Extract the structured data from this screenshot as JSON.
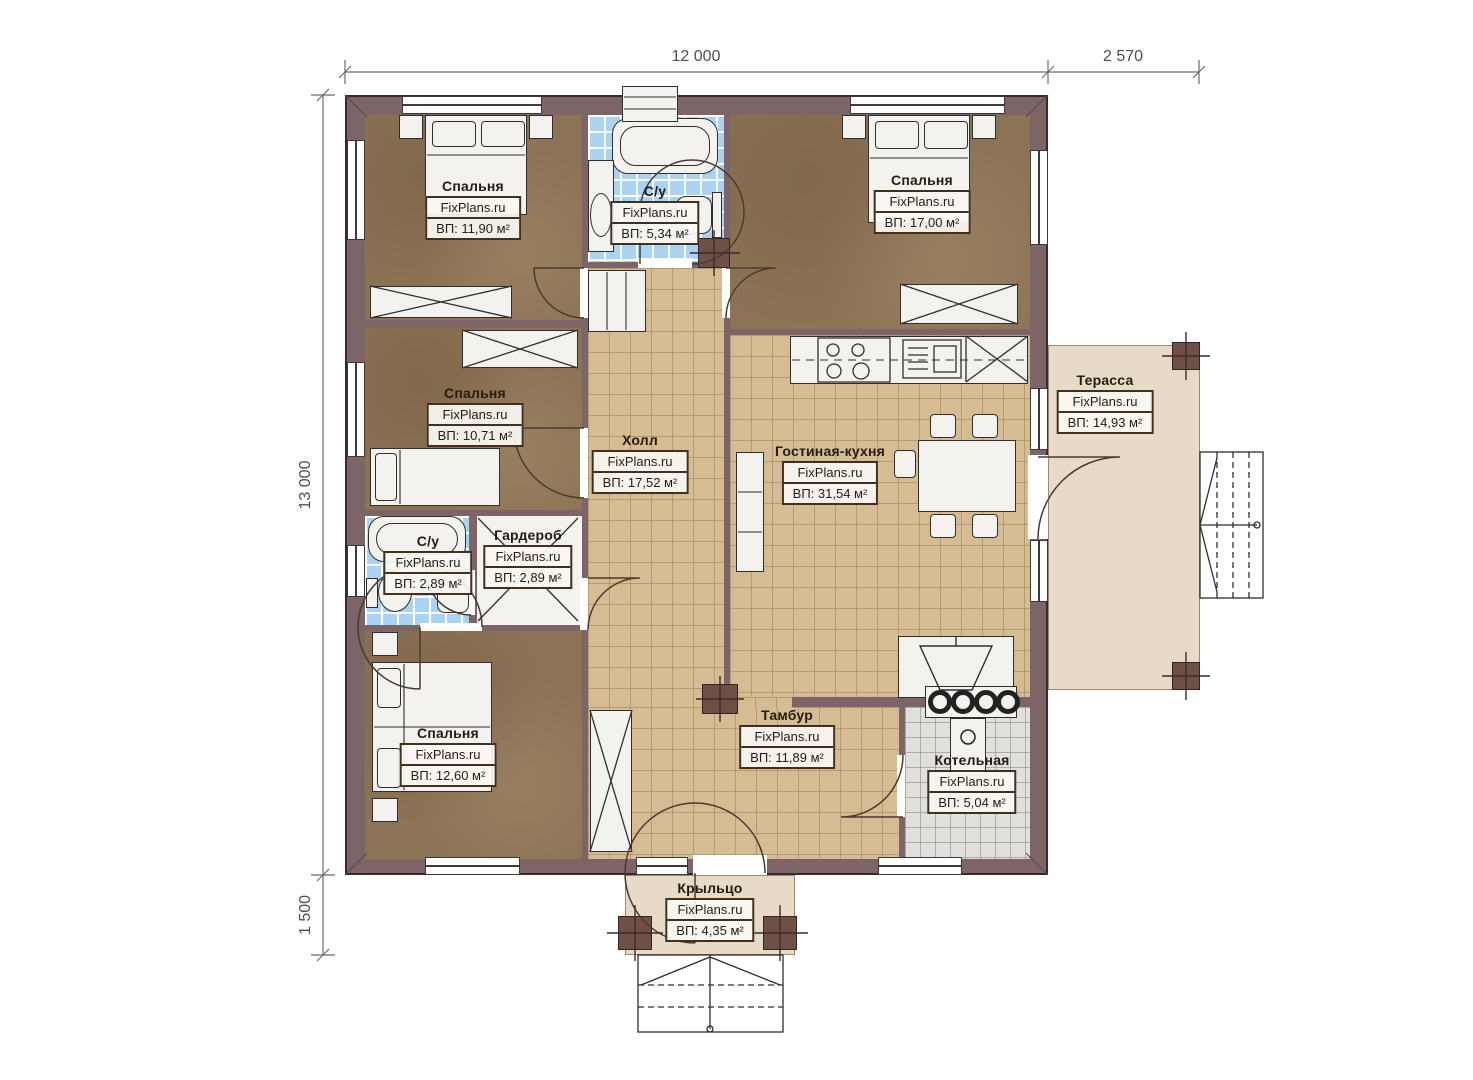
{
  "brand": "FixPlans.ru",
  "dimensions": {
    "top_main": "12 000",
    "top_right": "2 570",
    "left_main": "13 000",
    "left_bottom": "1 500"
  },
  "rooms": [
    {
      "key": "bedroom-top-left",
      "name": "Спальня",
      "area": "ВП: 11,90 м²"
    },
    {
      "key": "bathroom-top",
      "name": "С/у",
      "area": "ВП: 5,34 м²"
    },
    {
      "key": "bedroom-top-right",
      "name": "Спальня",
      "area": "ВП: 17,00 м²"
    },
    {
      "key": "bedroom-middle-left",
      "name": "Спальня",
      "area": "ВП: 10,71 м²"
    },
    {
      "key": "hall",
      "name": "Холл",
      "area": "ВП: 17,52 м²"
    },
    {
      "key": "living-kitchen",
      "name": "Гостиная-кухня",
      "area": "ВП: 31,54 м²"
    },
    {
      "key": "terrace",
      "name": "Терасса",
      "area": "ВП: 14,93 м²"
    },
    {
      "key": "bathroom-middle",
      "name": "С/у",
      "area": "ВП: 2,89 м²"
    },
    {
      "key": "wardrobe",
      "name": "Гардероб",
      "area": "ВП: 2,89 м²"
    },
    {
      "key": "bedroom-bottom-left",
      "name": "Спальня",
      "area": "ВП: 12,60 м²"
    },
    {
      "key": "tambour",
      "name": "Тамбур",
      "area": "ВП: 11,89 м²"
    },
    {
      "key": "boiler-room",
      "name": "Котельная",
      "area": "ВП: 5,04 м²"
    },
    {
      "key": "porch",
      "name": "Крыльцо",
      "area": "ВП: 4,35 м²"
    }
  ],
  "colors": {
    "wall": "#7d6467",
    "bedroom_floor": "#8d7355",
    "tile_floor": "#d6bc92",
    "bath_floor": "#abd2f1",
    "boiler_floor": "#e1e0dc",
    "terrace_floor": "#e7dac6"
  }
}
